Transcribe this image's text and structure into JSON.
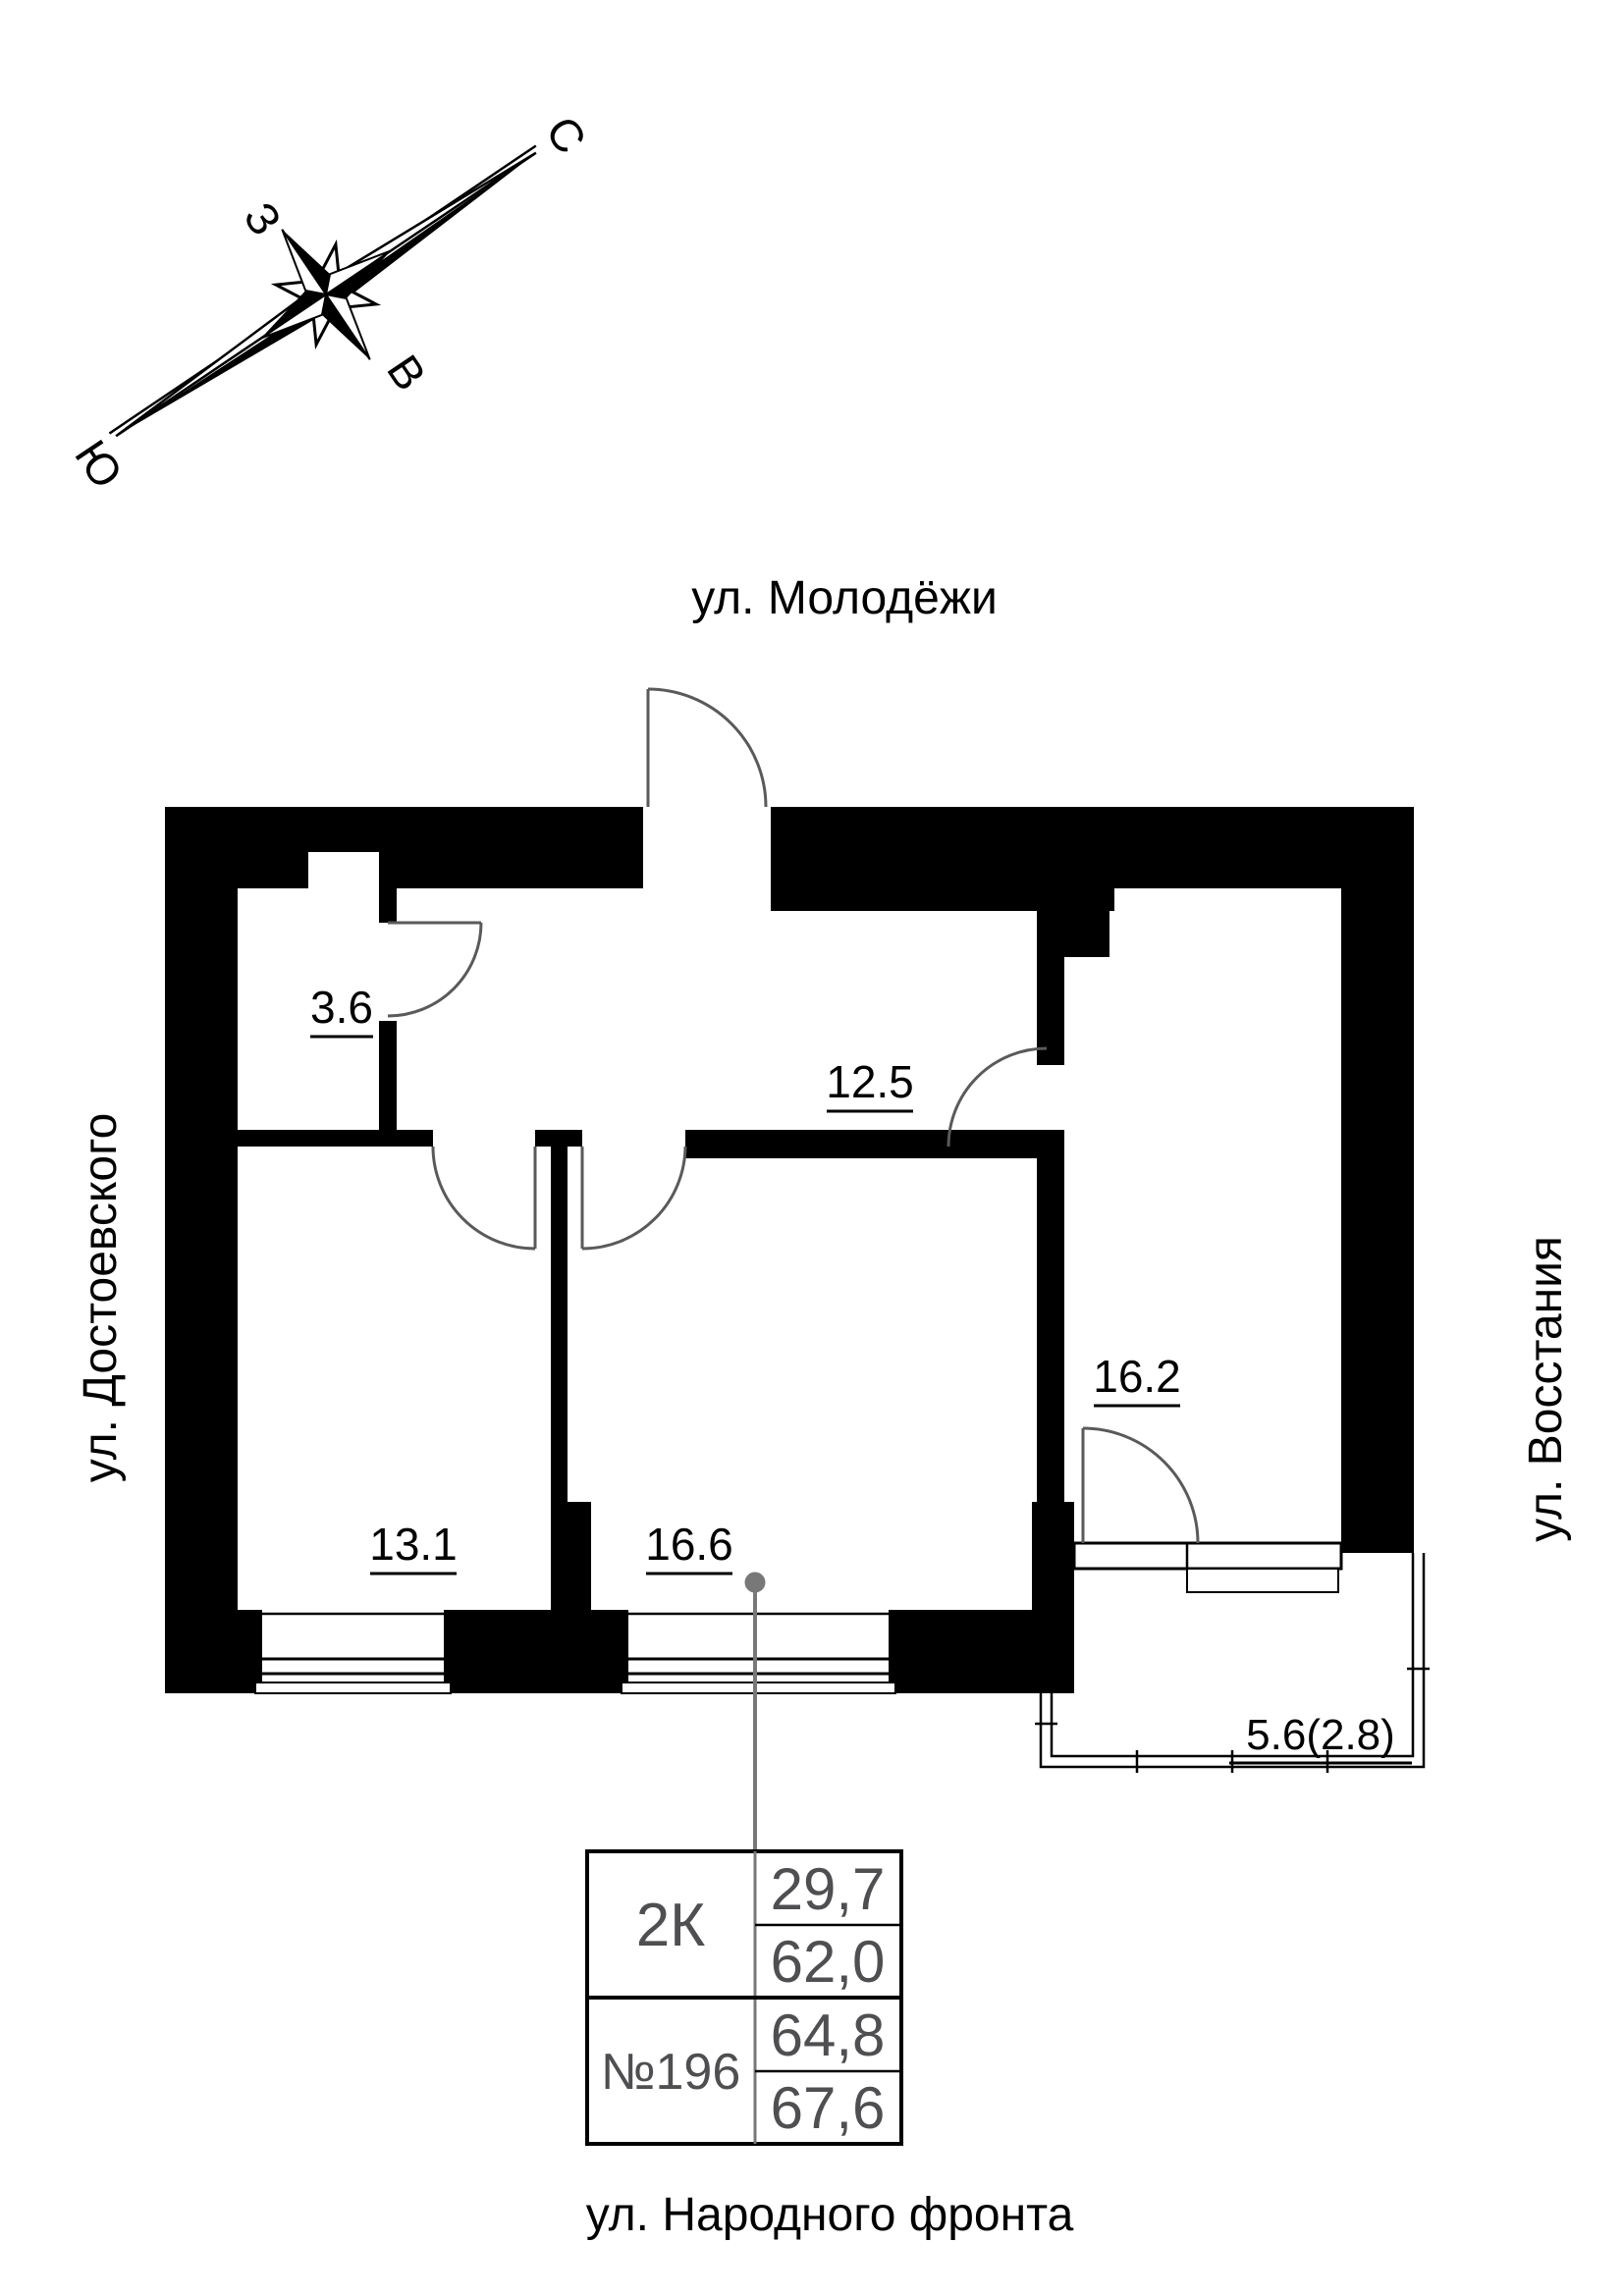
{
  "compass": {
    "n": "С",
    "w": "З",
    "e": "В",
    "s": "Ю"
  },
  "streets": {
    "top": "ул. Молодёжи",
    "left": "ул. Достоевского",
    "right": "ул. Восстания",
    "bottom": "ул. Народного фронта"
  },
  "rooms": [
    "3.6",
    "12.5",
    "13.1",
    "16.6",
    "16.2",
    "5.6(2.8)"
  ],
  "table": {
    "type": "2К",
    "number": "№196",
    "values": [
      "29,7",
      "62,0",
      "64,8",
      "67,6"
    ]
  },
  "colors": {
    "wall": "#000000",
    "door_arc": "#5a5a5a",
    "table_text": "#4f4f51",
    "leader": "#787878"
  }
}
